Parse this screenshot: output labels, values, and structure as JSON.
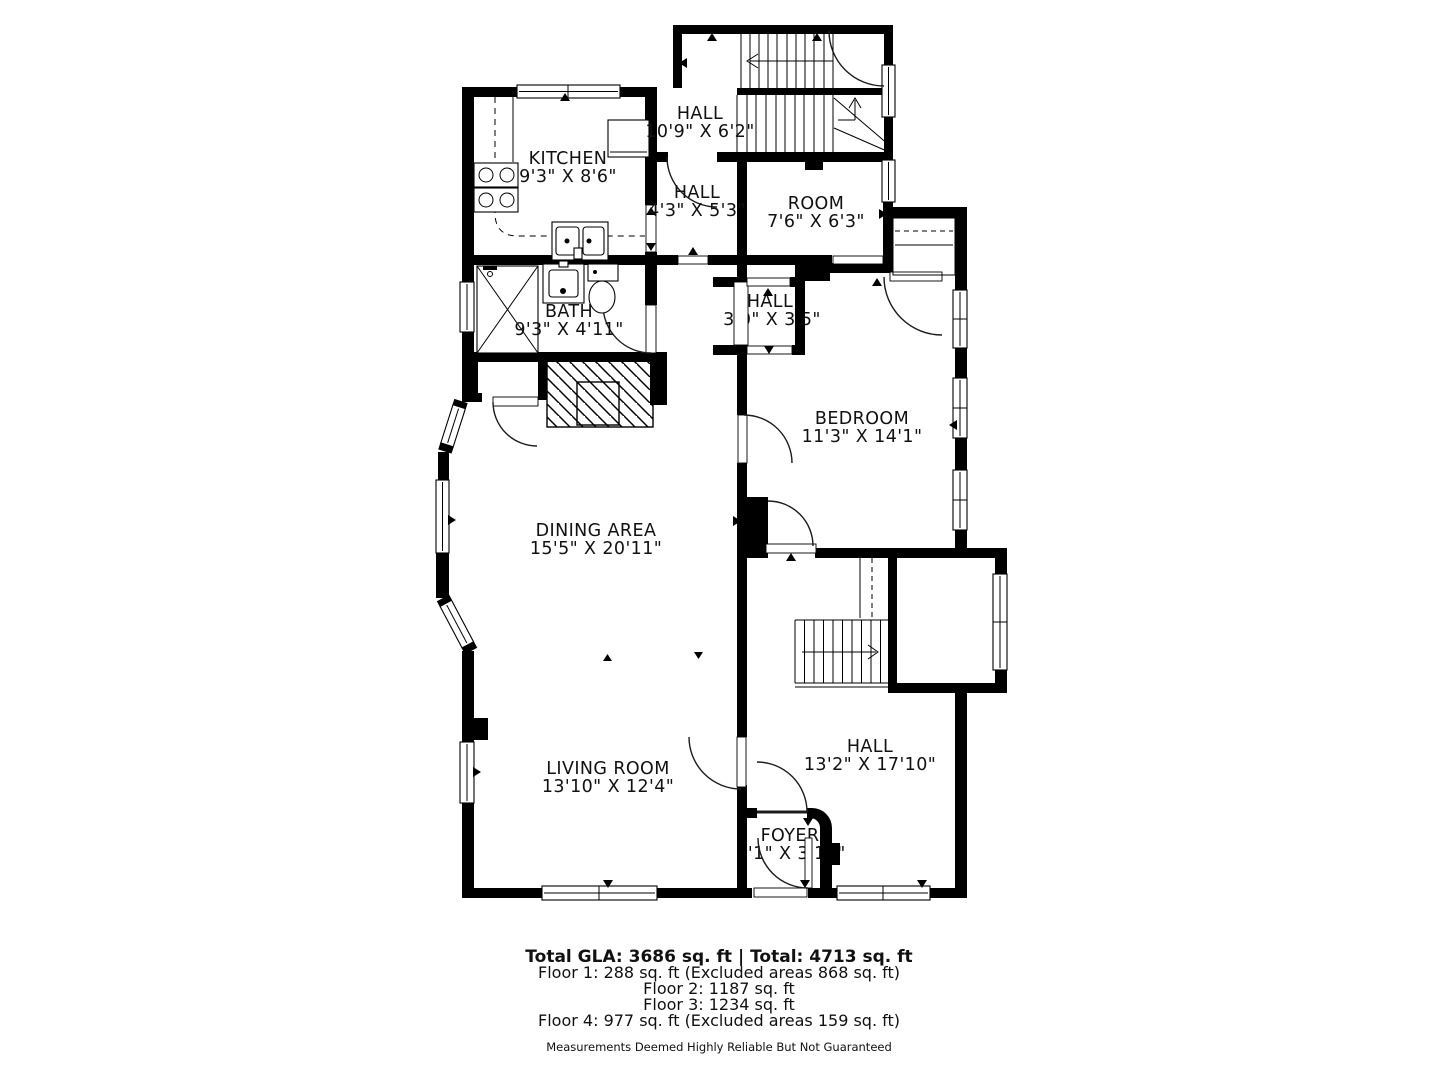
{
  "floorplan": {
    "colors": {
      "wall": "#000000",
      "background": "#ffffff",
      "text": "#111111"
    },
    "rooms": [
      {
        "name": "HALL",
        "dims": "10'9\" X 6'2\""
      },
      {
        "name": "KITCHEN",
        "dims": "9'3\" X 8'6\""
      },
      {
        "name": "HALL",
        "dims": "4'3\" X 5'3\""
      },
      {
        "name": "ROOM",
        "dims": "7'6\" X 6'3\""
      },
      {
        "name": "BATH",
        "dims": "9'3\" X 4'11\""
      },
      {
        "name": "HALL",
        "dims": "3'0\" X 3'5\""
      },
      {
        "name": "BEDROOM",
        "dims": "11'3\" X 14'1\""
      },
      {
        "name": "DINING AREA",
        "dims": "15'5\" X 20'11\""
      },
      {
        "name": "LIVING ROOM",
        "dims": "13'10\" X 12'4\""
      },
      {
        "name": "HALL",
        "dims": "13'2\" X 17'10\""
      },
      {
        "name": "FOYER",
        "dims": "4'1\" X 3'10\""
      }
    ],
    "summary": {
      "total_line": "Total GLA: 3686 sq. ft | Total: 4713 sq. ft",
      "floors": [
        "Floor 1: 288 sq. ft (Excluded areas 868 sq. ft)",
        "Floor 2: 1187 sq. ft",
        "Floor 3: 1234 sq. ft",
        "Floor 4: 977 sq. ft (Excluded areas 159 sq. ft)"
      ],
      "disclaimer": "Measurements Deemed Highly Reliable But Not Guaranteed"
    }
  }
}
